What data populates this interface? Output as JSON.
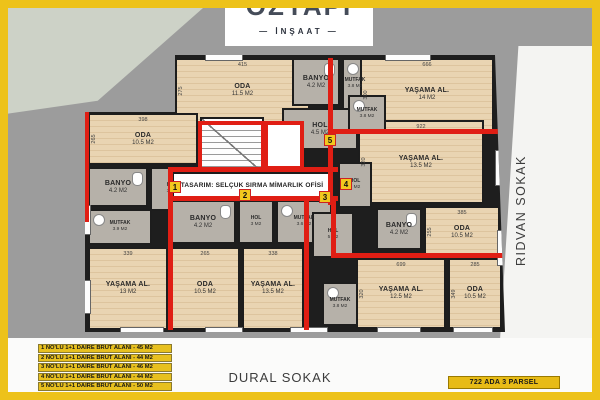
{
  "logo": {
    "name_partial": "ÖZYAPI",
    "subtitle": "— İNŞAAT —"
  },
  "streets": {
    "right": "RIDVAN SOKAK",
    "bottom": "DURAL SOKAK"
  },
  "parcel_badge": {
    "label": "722 ADA 3 PARSEL"
  },
  "design_credit": {
    "label": "TASARIM: SELÇUK SIRMA MİMARLIK OFİSİ"
  },
  "legend": {
    "items": [
      "1 NO'LU 1+1 DAIRE BRUT ALANI - 45 M2",
      "2 NO'LU 1+1 DAIRE BRUT ALANI - 44 M2",
      "3 NO'LU 1+1 DAIRE BRUT ALANI - 46 M2",
      "4 NO'LU 1+1 DAIRE BRUT ALANI - 44 M2",
      "5 NO'LU 1+1 DAIRE BRUT ALANI - 50 M2"
    ]
  },
  "unit_markers": [
    {
      "label": "1"
    },
    {
      "label": "2"
    },
    {
      "label": "3"
    },
    {
      "label": "4"
    },
    {
      "label": "5"
    }
  ],
  "rooms": [
    {
      "name": "ODA",
      "area": "11.5 M2",
      "dim_top": "415",
      "dim_side": "275"
    },
    {
      "name": "BANYO",
      "area": "4.2 M2"
    },
    {
      "name": "MUTFAK",
      "area": "3.8 M2"
    },
    {
      "name": "HOL",
      "area": "4.5 M2"
    },
    {
      "name": "YAŞAMA AL.",
      "area": "14 M2",
      "dim_top": "666",
      "dim_side": "300"
    },
    {
      "name": "ODA",
      "area": "10.5 M2",
      "dim_top": "398",
      "dim_side": "265"
    },
    {
      "name": "BANYO",
      "area": "4.2 M2"
    },
    {
      "name": "HOL",
      "area": "3 M2"
    },
    {
      "name": "MUTFAK",
      "area": "3.9 M2"
    },
    {
      "name": "YAŞAMA AL.",
      "area": "13 M2",
      "dim_top": "339"
    },
    {
      "name": "ODA",
      "area": "10.5 M2",
      "dim_top": "265"
    },
    {
      "name": "YAŞAMA AL.",
      "area": "13.5 M2",
      "dim_top": "338"
    },
    {
      "name": "BANYO",
      "area": "4.2 M2"
    },
    {
      "name": "HOL",
      "area": "3 M2"
    },
    {
      "name": "MUTFAK",
      "area": "3.6 M2"
    },
    {
      "name": "YAŞAMA AL.",
      "area": "13.5 M2",
      "dim_top": "922",
      "dim_side": "320"
    },
    {
      "name": "MUTFAK",
      "area": "3.8 M2"
    },
    {
      "name": "HOL",
      "area": "3 M2"
    },
    {
      "name": "BANYO",
      "area": "4.2 M2"
    },
    {
      "name": "ODA",
      "area": "10.5 M2",
      "dim_top": "385",
      "dim_side": "255"
    },
    {
      "name": "HOL",
      "area": "5 M2"
    },
    {
      "name": "MUTFAK",
      "area": "3.8 M2"
    },
    {
      "name": "YAŞAMA AL.",
      "area": "12.5 M2",
      "dim_top": "699",
      "dim_side": "320"
    },
    {
      "name": "ODA",
      "area": "10.5 M2",
      "dim_top": "285",
      "dim_side": "349"
    }
  ],
  "colors": {
    "frame": "#edc21a",
    "site": "#9c9c9c",
    "unit_wall_red": "#e01e14",
    "wood_floor": "#e9d4b2",
    "tile_floor": "#b6b1a9"
  }
}
